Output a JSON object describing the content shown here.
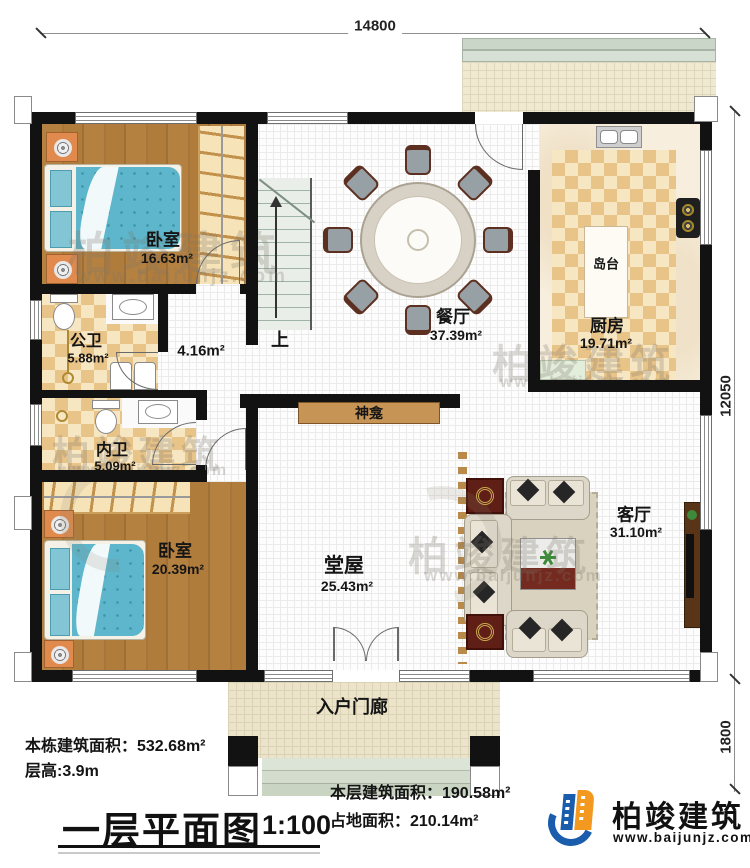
{
  "dims": {
    "top": "14800",
    "right_main": "12050",
    "right_porch": "1800"
  },
  "rooms": {
    "bedroom_top": {
      "name": "卧室",
      "area": "16.63m²"
    },
    "public_bath": {
      "name": "公卫",
      "area": "5.88m²"
    },
    "inner_bath": {
      "name": "内卫",
      "area": "5.09m²"
    },
    "corridor": {
      "area": "4.16m²"
    },
    "bedroom_bottom": {
      "name": "卧室",
      "area": "20.39m²"
    },
    "dining": {
      "name": "餐厅",
      "area": "37.39m²"
    },
    "kitchen": {
      "name": "厨房",
      "area": "19.71m²"
    },
    "island": {
      "name": "岛台"
    },
    "main_hall": {
      "name": "堂屋",
      "area": "25.43m²"
    },
    "living": {
      "name": "客厅",
      "area": "31.10m²"
    },
    "shrine": {
      "name": "神龛"
    },
    "porch": {
      "name": "入户门廊"
    },
    "stairs": {
      "up_label": "上"
    }
  },
  "titleblock": {
    "building_area": "本栋建筑面积：532.68m²",
    "floor_height": "层高:3.9m",
    "plan_title": "一层平面图",
    "plan_scale": "1:100",
    "floor_area": "本层建筑面积：190.58m²",
    "footprint_area": "占地面积：210.14m²"
  },
  "brand": {
    "name": "柏竣建筑",
    "site": "www.baijunjz.com"
  },
  "watermark": {
    "name": "柏竣建筑",
    "site": "www.baijunjz.com"
  },
  "colors": {
    "wall": "#121212",
    "wood_floor": "#ae7b3c",
    "mattress": "#5db6cb",
    "tile": "#e9c489",
    "logo_blue": "#1b5dad",
    "logo_orange": "#f3991f"
  }
}
